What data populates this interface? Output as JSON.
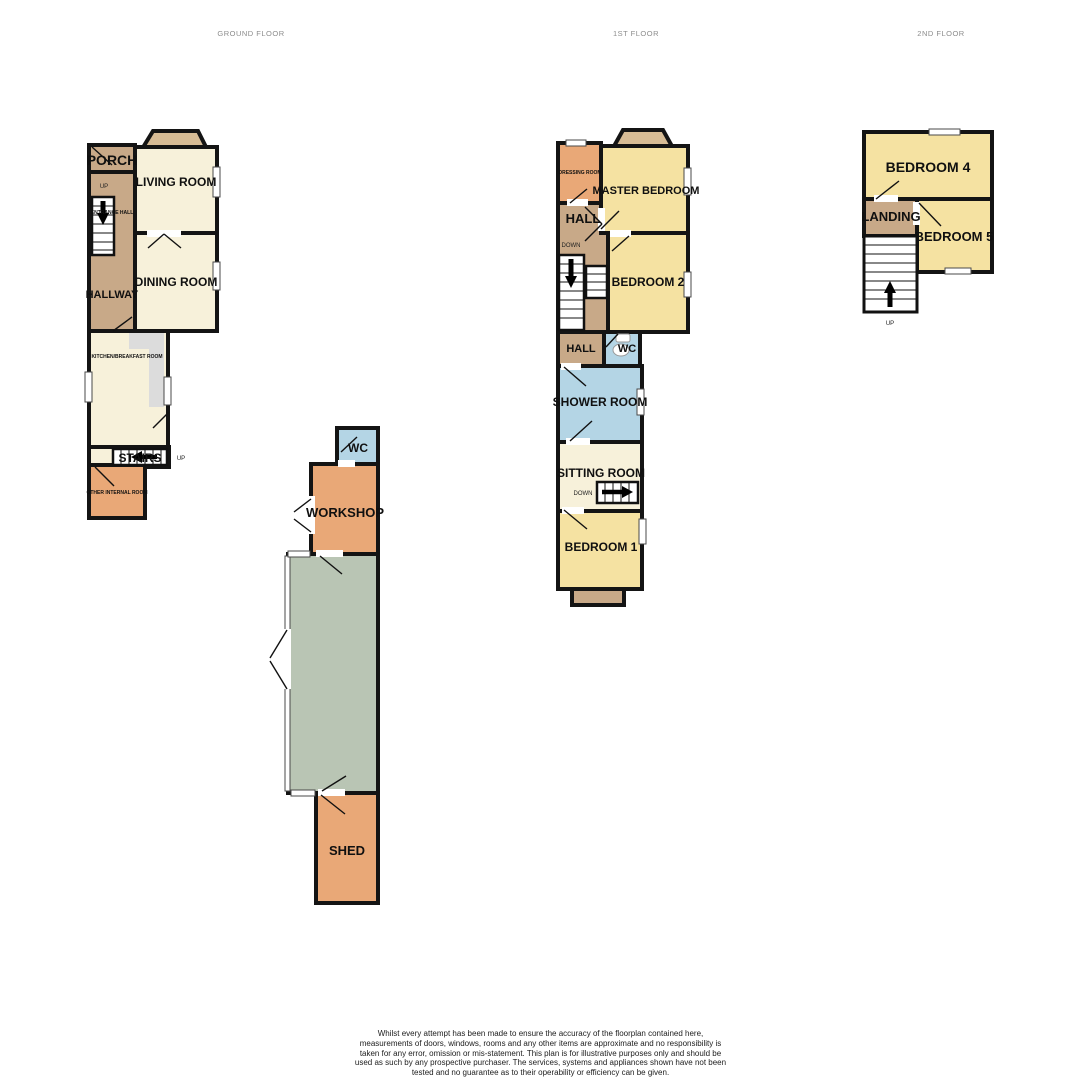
{
  "palette": {
    "wall": "#141414",
    "cream": "#f7f1da",
    "yellow": "#f5e2a2",
    "tan": "#c8a988",
    "bay": "#d7bc95",
    "orange": "#e9a877",
    "blue": "#b4d5e5",
    "sage": "#b9c5b4",
    "counter": "#dcdcdc",
    "white": "#ffffff"
  },
  "titles": {
    "ground": "GROUND FLOOR",
    "first": "1ST FLOOR",
    "second": "2ND FLOOR"
  },
  "ground_floor": {
    "porch": "PORCH",
    "living_room": "LIVING ROOM",
    "up_small": "UP",
    "entrance_hall": "ENTRANCE HALL",
    "hallway": "HALLWAY",
    "dining_room": "DINING ROOM",
    "kitchen": "KITCHEN/BREAKFAST ROOM",
    "stairs": "STAIRS",
    "stairs_up": "UP",
    "other_internal_room": "OTHER INTERNAL ROOM"
  },
  "outbuilding": {
    "wc": "WC",
    "workshop": "WORKSHOP",
    "shed": "SHED"
  },
  "first_floor": {
    "dressing_room": "DRESSING ROOM",
    "master_bedroom": "MASTER BEDROOM",
    "hall_upper": "HALL",
    "down_upper": "DOWN",
    "bedroom_2": "BEDROOM 2",
    "hall_lower": "HALL",
    "wc": "WC",
    "shower_room": "SHOWER ROOM",
    "sitting_room": "SITTING ROOM",
    "down_lower": "DOWN",
    "bedroom_1": "BEDROOM 1"
  },
  "second_floor": {
    "bedroom_4": "BEDROOM 4",
    "landing": "LANDING",
    "bedroom_5": "BEDROOM 5",
    "up": "UP"
  },
  "footer": {
    "disclaimer": "Whilst every attempt has been made to ensure the accuracy of the floorplan contained here, measurements of doors, windows, rooms and any other items are approximate and no responsibility is taken for any error, omission or mis-statement. This plan is for illustrative purposes only and should be used as such by any prospective purchaser. The services, systems and appliances shown have not been tested and no guarantee as to their operability or efficiency can be given.",
    "credit": "Made with Metropix ©2026"
  }
}
